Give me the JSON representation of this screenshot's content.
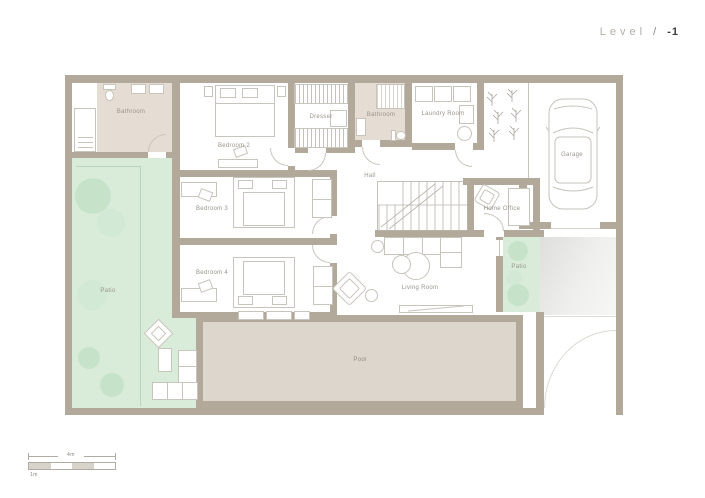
{
  "title": {
    "label": "Level",
    "separator": "/",
    "level": "-1"
  },
  "rooms": {
    "bathroom1": "Bathroom",
    "bedroom2": "Bedroom 2",
    "dresser": "Dresser",
    "bathroom2": "Bathroom",
    "laundry": "Laundry Room",
    "garage": "Garage",
    "hall": "Hall",
    "home_office": "Home Office",
    "bedroom3": "Bedroom 3",
    "bedroom4": "Bedroom 4",
    "living_room": "Living Room",
    "patio_left": "Patio",
    "patio_right": "Patio",
    "pool": "Pool"
  },
  "scale_bar": {
    "total": "4m",
    "unit": "1m"
  },
  "colors": {
    "wall": "#b3a99b",
    "patio_green": "#d9ecda",
    "tree_green": "#c6e3c9",
    "pool_fill": "#dcd6cc",
    "bath_floor": "#e5ddd3",
    "furniture_line": "#c7c4bc",
    "label_text": "#99948b"
  }
}
